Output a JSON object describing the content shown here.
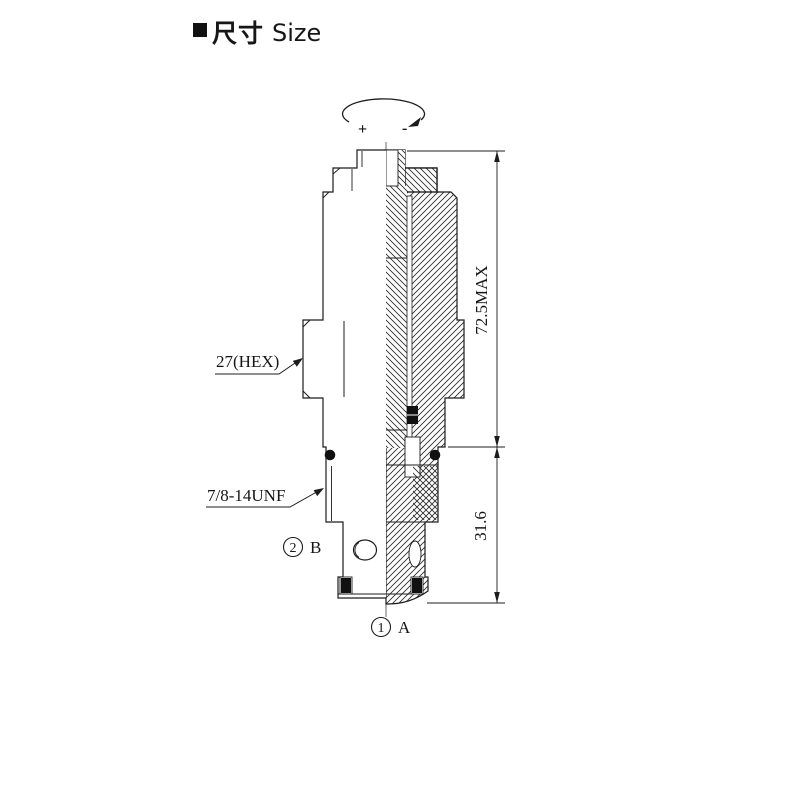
{
  "drawing": {
    "kind": "valve-cartridge-dimension-drawing",
    "colors": {
      "line": "#1c1c1c",
      "background": "#ffffff",
      "fill_black": "#111111"
    }
  },
  "title": {
    "cn": "尺寸",
    "en": "Size"
  },
  "rotation": {
    "plus": "+",
    "minus": "-"
  },
  "dims": {
    "overall": "72.5MAX",
    "thread": "31.6"
  },
  "callouts": {
    "hex": "27(HEX)",
    "thread": "7/8-14UNF"
  },
  "ports": {
    "b_num": "2",
    "b_label": "B",
    "a_num": "1",
    "a_label": "A"
  }
}
